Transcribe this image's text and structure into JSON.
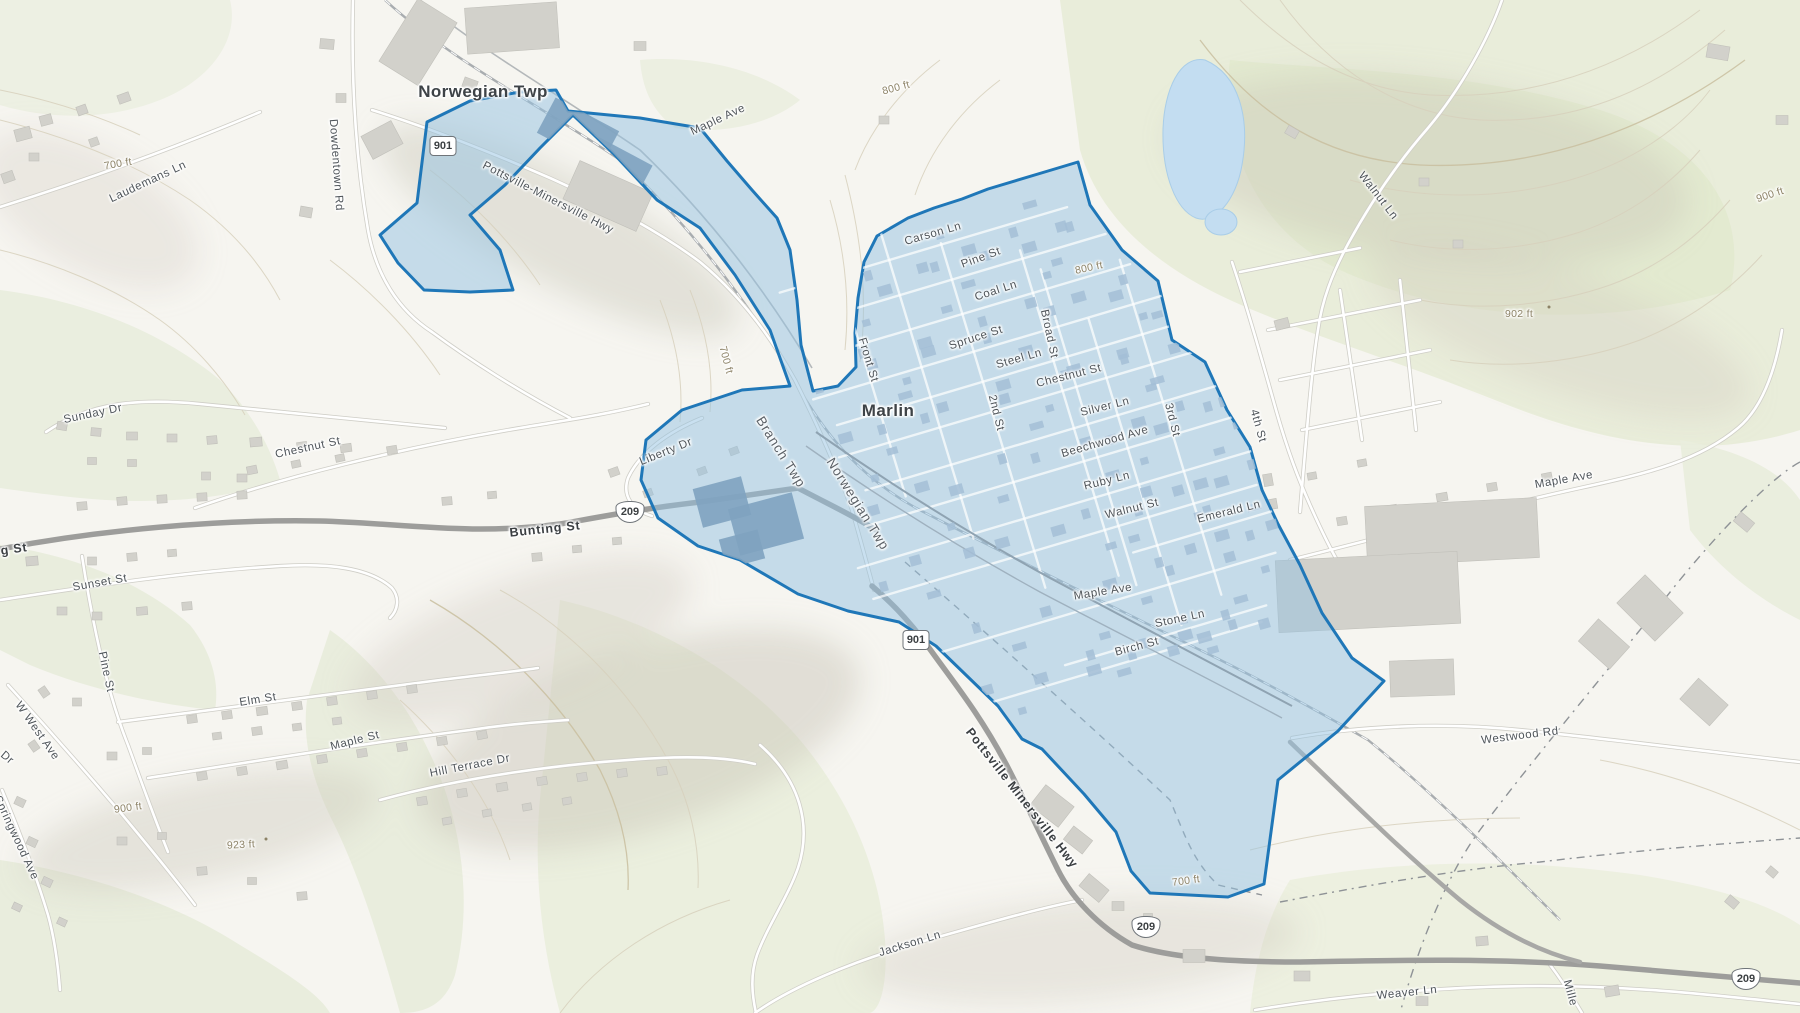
{
  "map": {
    "region": {
      "name": "Marlin boundary",
      "fill": "#93c2e2",
      "stroke": "#1f77b8"
    },
    "place_labels": [
      {
        "id": "norwegian-twp",
        "text": "Norwegian Twp",
        "x": 483,
        "y": 92,
        "r": 0
      },
      {
        "id": "marlin",
        "text": "Marlin",
        "x": 888,
        "y": 411,
        "r": 0
      }
    ],
    "township_labels": [
      {
        "id": "branch-twp",
        "text": "Branch Twp",
        "x": 781,
        "y": 452,
        "r": 58
      },
      {
        "id": "norwegian-twp-2",
        "text": "Norwegian Twp",
        "x": 858,
        "y": 504,
        "r": 58
      }
    ],
    "road_labels": [
      {
        "id": "laudemans-ln",
        "text": "Laudemans Ln",
        "x": 148,
        "y": 182,
        "r": -25
      },
      {
        "id": "dowdentown-rd",
        "text": "Dowdentown Rd",
        "x": 336,
        "y": 165,
        "r": 86
      },
      {
        "id": "pottsville-minersville-hwy-nw",
        "text": "Pottsville-Minersville Hwy",
        "x": 548,
        "y": 198,
        "r": 27
      },
      {
        "id": "maple-ave-nw",
        "text": "Maple Ave",
        "x": 718,
        "y": 120,
        "r": -25
      },
      {
        "id": "carson-ln",
        "text": "Carson Ln",
        "x": 933,
        "y": 234,
        "r": -16
      },
      {
        "id": "pine-st-town",
        "text": "Pine St",
        "x": 981,
        "y": 258,
        "r": -20
      },
      {
        "id": "coal-ln",
        "text": "Coal Ln",
        "x": 996,
        "y": 291,
        "r": -18
      },
      {
        "id": "spruce-st",
        "text": "Spruce St",
        "x": 976,
        "y": 338,
        "r": -18
      },
      {
        "id": "steel-ln",
        "text": "Steel Ln",
        "x": 1019,
        "y": 359,
        "r": -16
      },
      {
        "id": "chestnut-st-town",
        "text": "Chestnut St",
        "x": 1069,
        "y": 376,
        "r": -14
      },
      {
        "id": "silver-ln",
        "text": "Silver Ln",
        "x": 1105,
        "y": 407,
        "r": -14
      },
      {
        "id": "beechwood-ave",
        "text": "Beechwood Ave",
        "x": 1105,
        "y": 442,
        "r": -16
      },
      {
        "id": "ruby-ln",
        "text": "Ruby Ln",
        "x": 1107,
        "y": 481,
        "r": -14
      },
      {
        "id": "walnut-st",
        "text": "Walnut St",
        "x": 1132,
        "y": 509,
        "r": -14
      },
      {
        "id": "emerald-ln",
        "text": "Emerald Ln",
        "x": 1229,
        "y": 512,
        "r": -14
      },
      {
        "id": "maple-ave-town",
        "text": "Maple Ave",
        "x": 1103,
        "y": 592,
        "r": -9
      },
      {
        "id": "stone-ln",
        "text": "Stone Ln",
        "x": 1180,
        "y": 619,
        "r": -12
      },
      {
        "id": "birch-st",
        "text": "Birch St",
        "x": 1137,
        "y": 647,
        "r": -15
      },
      {
        "id": "front-st",
        "text": "Front St",
        "x": 868,
        "y": 360,
        "r": 73
      },
      {
        "id": "2nd-st",
        "text": "2nd St",
        "x": 996,
        "y": 413,
        "r": 76
      },
      {
        "id": "broad-st",
        "text": "Broad St",
        "x": 1049,
        "y": 334,
        "r": 78
      },
      {
        "id": "3rd-st",
        "text": "3rd St",
        "x": 1172,
        "y": 420,
        "r": 76
      },
      {
        "id": "4th-st",
        "text": "4th St",
        "x": 1258,
        "y": 426,
        "r": 74
      },
      {
        "id": "sunday-dr",
        "text": "Sunday Dr",
        "x": 93,
        "y": 414,
        "r": -12
      },
      {
        "id": "chestnut-st-w",
        "text": "Chestnut St",
        "x": 308,
        "y": 448,
        "r": -12
      },
      {
        "id": "liberty-dr",
        "text": "Liberty Dr",
        "x": 666,
        "y": 452,
        "r": -22
      },
      {
        "id": "sunset-st",
        "text": "Sunset St",
        "x": 100,
        "y": 583,
        "r": -10
      },
      {
        "id": "pine-st-w",
        "text": "Pine St",
        "x": 106,
        "y": 672,
        "r": 78
      },
      {
        "id": "w-west-ave",
        "text": "W West Ave",
        "x": 37,
        "y": 731,
        "r": 55
      },
      {
        "id": "dr-partial",
        "text": "Dr",
        "x": 7,
        "y": 758,
        "r": 40
      },
      {
        "id": "elm-st",
        "text": "Elm St",
        "x": 258,
        "y": 700,
        "r": -9
      },
      {
        "id": "maple-st-w",
        "text": "Maple St",
        "x": 355,
        "y": 741,
        "r": -14
      },
      {
        "id": "hill-terrace-dr",
        "text": "Hill Terrace Dr",
        "x": 470,
        "y": 766,
        "r": -11
      },
      {
        "id": "springwood-ave",
        "text": "Springwood Ave",
        "x": 16,
        "y": 838,
        "r": 65
      },
      {
        "id": "jackson-ln",
        "text": "Jackson Ln",
        "x": 910,
        "y": 944,
        "r": -17
      },
      {
        "id": "weaver-ln",
        "text": "Weaver Ln",
        "x": 1407,
        "y": 993,
        "r": -6
      },
      {
        "id": "mille-partial",
        "text": "Mille",
        "x": 1570,
        "y": 993,
        "r": 75
      },
      {
        "id": "westwood-rd",
        "text": "Westwood Rd",
        "x": 1520,
        "y": 736,
        "r": -7
      },
      {
        "id": "maple-ave-e",
        "text": "Maple Ave",
        "x": 1564,
        "y": 480,
        "r": -10
      },
      {
        "id": "walnut-ln",
        "text": "Walnut Ln",
        "x": 1378,
        "y": 196,
        "r": 52
      }
    ],
    "major_road_labels": [
      {
        "id": "bunting-st",
        "text": "Bunting St",
        "x": 545,
        "y": 529,
        "r": -6
      },
      {
        "id": "g-st-partial",
        "text": "g St",
        "x": 14,
        "y": 549,
        "r": -8
      },
      {
        "id": "pottsville-minersville-hwy-s",
        "text": "Pottsville Minersville Hwy",
        "x": 1022,
        "y": 798,
        "r": 52
      }
    ],
    "elevation_labels": [
      {
        "id": "elev-700-nw",
        "text": "700 ft",
        "x": 118,
        "y": 164,
        "r": -10
      },
      {
        "id": "elev-800-n",
        "text": "800 ft",
        "x": 896,
        "y": 88,
        "r": -15
      },
      {
        "id": "elev-800-ne",
        "text": "800 ft",
        "x": 1089,
        "y": 268,
        "r": -12
      },
      {
        "id": "elev-902",
        "text": "902 ft",
        "x": 1519,
        "y": 314,
        "r": 0
      },
      {
        "id": "elev-900-e",
        "text": "900 ft",
        "x": 1770,
        "y": 195,
        "r": -18
      },
      {
        "id": "elev-700-c",
        "text": "700 ft",
        "x": 726,
        "y": 360,
        "r": 75
      },
      {
        "id": "elev-700-s",
        "text": "700 ft",
        "x": 1186,
        "y": 881,
        "r": -8
      },
      {
        "id": "elev-900-w",
        "text": "900 ft",
        "x": 128,
        "y": 808,
        "r": -8
      },
      {
        "id": "elev-923",
        "text": "923 ft",
        "x": 241,
        "y": 845,
        "r": -3
      }
    ],
    "spot_elevation_dots": [
      {
        "x": 1549,
        "y": 307
      },
      {
        "x": 266,
        "y": 839
      }
    ],
    "route_shields": [
      {
        "id": "shield-901-nw",
        "kind": "pa",
        "number": "901",
        "x": 443,
        "y": 146
      },
      {
        "id": "shield-901-s",
        "kind": "pa",
        "number": "901",
        "x": 916,
        "y": 640
      },
      {
        "id": "shield-209-w",
        "kind": "us",
        "number": "209",
        "x": 630,
        "y": 512
      },
      {
        "id": "shield-209-c",
        "kind": "us",
        "number": "209",
        "x": 1146,
        "y": 927
      },
      {
        "id": "shield-209-e",
        "kind": "us",
        "number": "209",
        "x": 1746,
        "y": 979
      }
    ]
  }
}
